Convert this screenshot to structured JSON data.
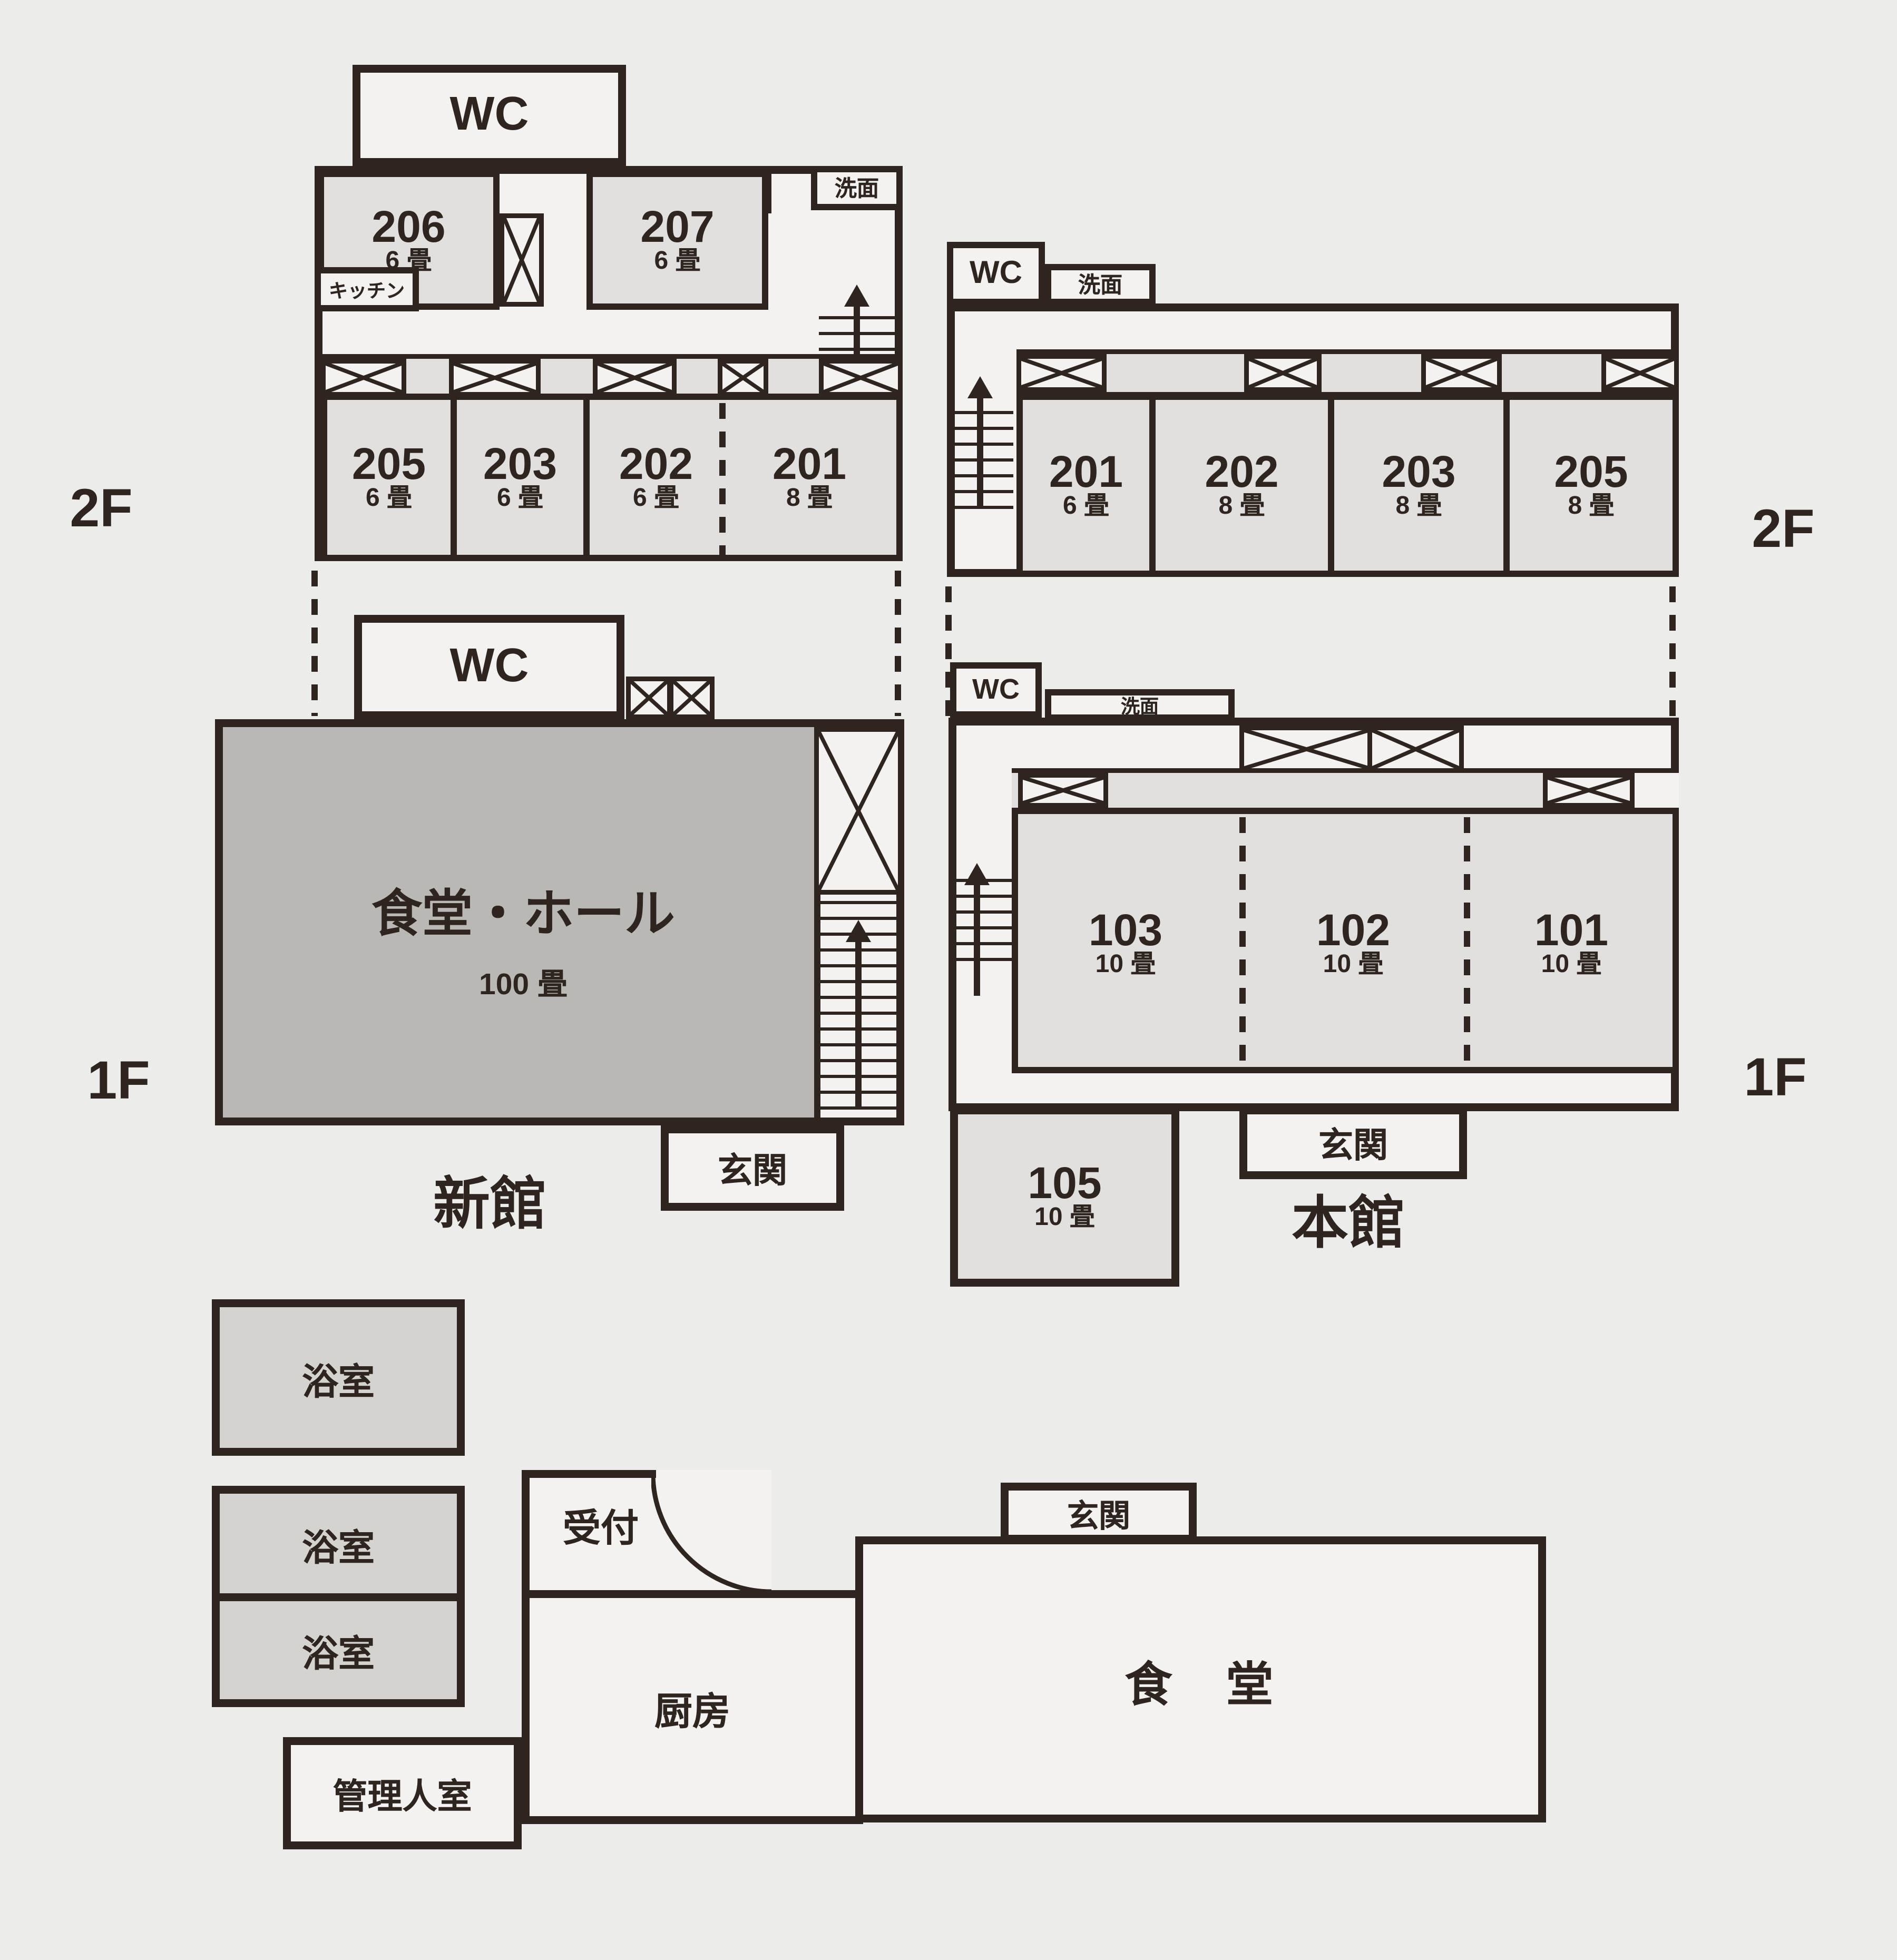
{
  "colors": {
    "wall": "#2e2520",
    "background": "#ececeb",
    "room_fill": "#e1e0de",
    "hall_fill": "#b9b8b5",
    "bath_fill": "#d4d3d0",
    "white_fill": "#f3f2f0"
  },
  "floor_labels": {
    "left_2f": "2F",
    "right_2f": "2F",
    "left_1f": "1F",
    "right_1f": "1F"
  },
  "shinkan": {
    "name": "新館",
    "f2": {
      "wc": "WC",
      "senmen": "洗面",
      "kitchen": "キッチン",
      "room206": {
        "no": "206",
        "size": "6 畳"
      },
      "room207": {
        "no": "207",
        "size": "6 畳"
      },
      "room205": {
        "no": "205",
        "size": "6 畳"
      },
      "room203": {
        "no": "203",
        "size": "6 畳"
      },
      "room202": {
        "no": "202",
        "size": "6 畳"
      },
      "room201": {
        "no": "201",
        "size": "8 畳"
      }
    },
    "f1": {
      "wc": "WC",
      "hall_name": "食堂・ホール",
      "hall_size": "100 畳",
      "genkan": "玄関"
    }
  },
  "honkan": {
    "name": "本館",
    "f2": {
      "wc": "WC",
      "senmen": "洗面",
      "room201": {
        "no": "201",
        "size": "6 畳"
      },
      "room202": {
        "no": "202",
        "size": "8 畳"
      },
      "room203": {
        "no": "203",
        "size": "8 畳"
      },
      "room205": {
        "no": "205",
        "size": "8 畳"
      }
    },
    "f1": {
      "wc": "WC",
      "senmen": "洗面",
      "room103": {
        "no": "103",
        "size": "10 畳"
      },
      "room102": {
        "no": "102",
        "size": "10 畳"
      },
      "room101": {
        "no": "101",
        "size": "10 畳"
      },
      "room105": {
        "no": "105",
        "size": "10 畳"
      },
      "genkan": "玄関"
    }
  },
  "ground": {
    "bath1": "浴室",
    "bath2": "浴室",
    "bath3": "浴室",
    "reception": "受付",
    "kitchen": "厨房",
    "manager": "管理人室",
    "genkan": "玄関",
    "dining": "食　堂"
  }
}
